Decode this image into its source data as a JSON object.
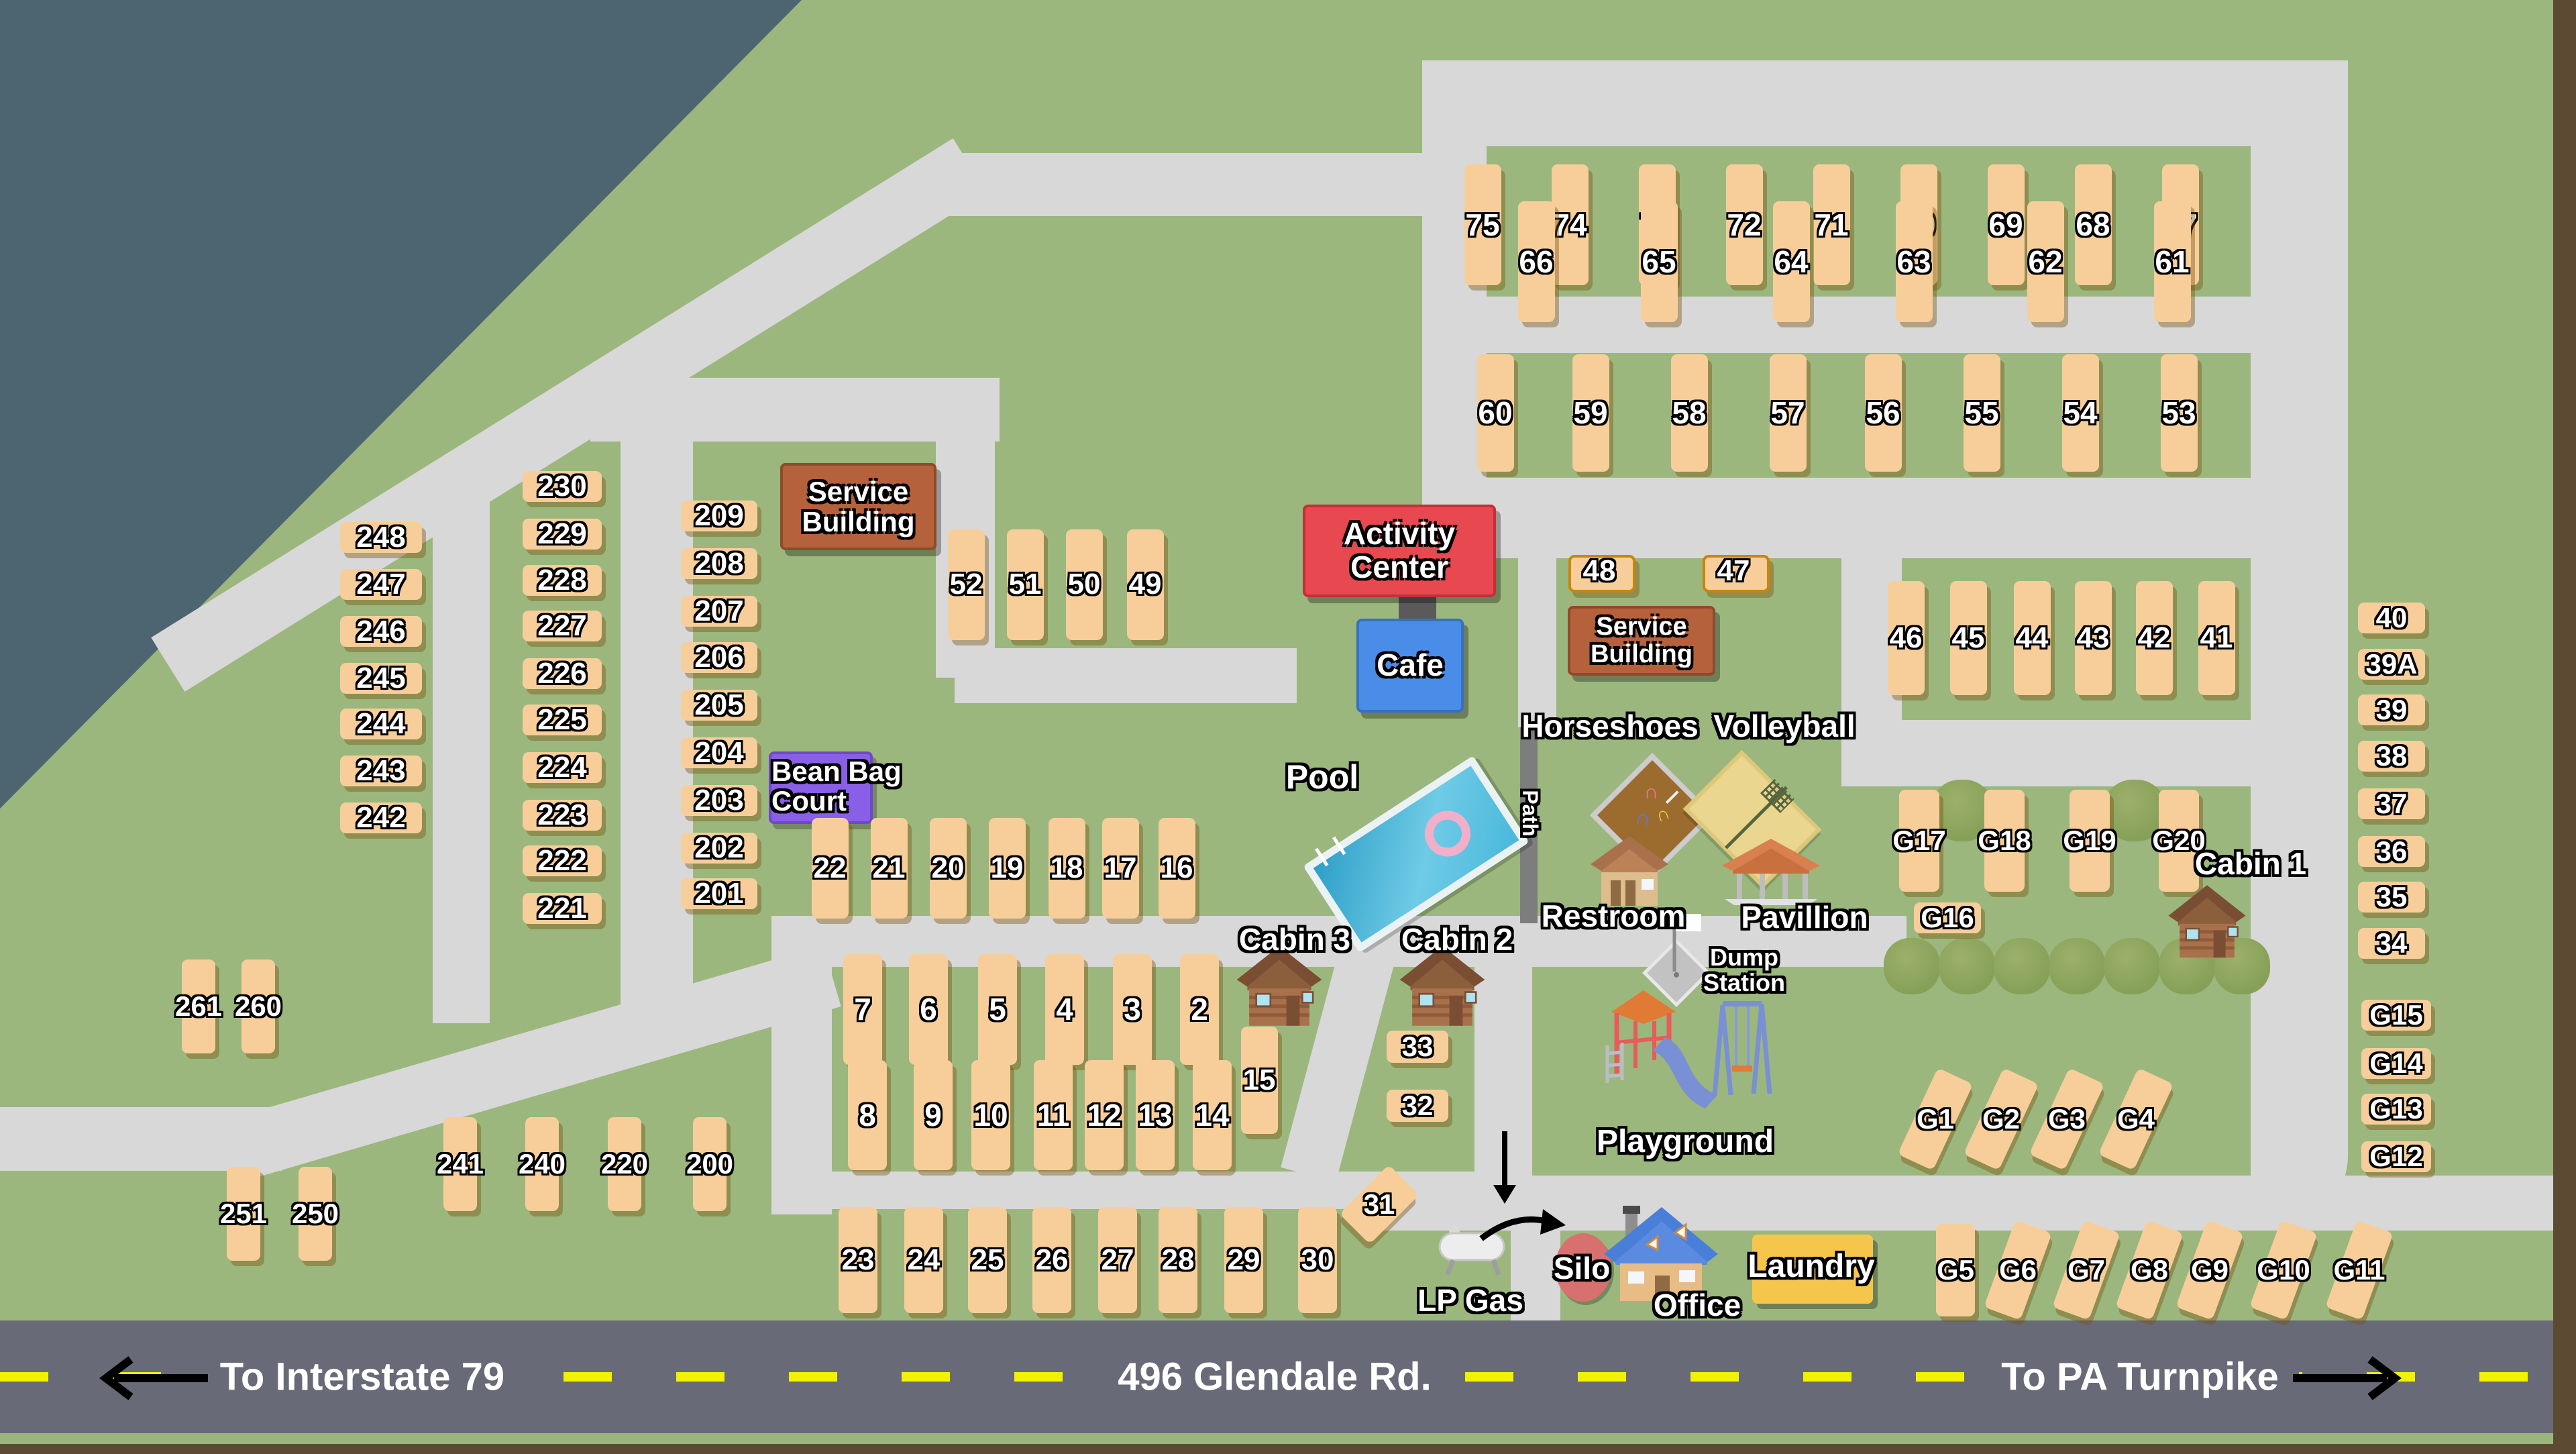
{
  "sites": {
    "row_75_67": [
      "75",
      "74",
      "73",
      "72",
      "71",
      "70",
      "69",
      "68",
      "67"
    ],
    "row_66_61": [
      "66",
      "65",
      "64",
      "63",
      "62",
      "61"
    ],
    "row_60_53": [
      "60",
      "59",
      "58",
      "57",
      "56",
      "55",
      "54",
      "53"
    ],
    "col_248_242": [
      "248",
      "247",
      "246",
      "245",
      "244",
      "243",
      "242"
    ],
    "col_230_221": [
      "230",
      "229",
      "228",
      "227",
      "226",
      "225",
      "224",
      "223",
      "222",
      "221"
    ],
    "col_209_201": [
      "209",
      "208",
      "207",
      "206",
      "205",
      "204",
      "203",
      "202",
      "201"
    ],
    "row_52_49": [
      "52",
      "51",
      "50",
      "49"
    ],
    "pair_48_47": [
      "48",
      "47"
    ],
    "row_46_41": [
      "46",
      "45",
      "44",
      "43",
      "42",
      "41"
    ],
    "col_40_34": [
      "40",
      "39A",
      "39",
      "38",
      "37",
      "36",
      "35",
      "34"
    ],
    "col_g15_g12": [
      "G15",
      "G14",
      "G13",
      "G12"
    ],
    "row_22_16": [
      "22",
      "21",
      "20",
      "19",
      "18",
      "17",
      "16"
    ],
    "row_7_2": [
      "7",
      "6",
      "5",
      "4",
      "3",
      "2"
    ],
    "site_15": [
      "15"
    ],
    "row_8_14": [
      "8",
      "9",
      "10",
      "11",
      "12",
      "13",
      "14"
    ],
    "row_23_30": [
      "23",
      "24",
      "25",
      "26",
      "27",
      "28",
      "29",
      "30"
    ],
    "pair_261_260": [
      "261",
      "260"
    ],
    "row_241_200": [
      "241",
      "240",
      "220",
      "200"
    ],
    "pair_251_250": [
      "251",
      "250"
    ],
    "col_33_32": [
      "33",
      "32"
    ],
    "site_31": [
      "31"
    ],
    "row_g17_g20": [
      "G17",
      "G18",
      "G19",
      "G20"
    ],
    "site_g16": [
      "G16"
    ],
    "row_g1_g4": [
      "G1",
      "G2",
      "G3",
      "G4"
    ],
    "row_g5_g11": [
      "G5",
      "G6",
      "G7",
      "G8",
      "G9",
      "G10",
      "G11"
    ]
  },
  "buildings": {
    "service_building_1": "Service Building",
    "service_building_2": "Service Building",
    "activity_center": "Activity Center",
    "cafe": "Cafe",
    "bean_bag_court": "Bean Bag Court",
    "laundry": "Laundry",
    "office": "Office",
    "silo": "Silo",
    "lp_gas": "LP Gas"
  },
  "amenities": {
    "pool": "Pool",
    "path": "Path",
    "horseshoes": "Horseshoes",
    "volleyball": "Volleyball",
    "restroom": "Restroom",
    "pavillion": "Pavillion",
    "playground": "Playground",
    "dump_station": "Dump Station",
    "cabin_1": "Cabin 1",
    "cabin_2": "Cabin 2",
    "cabin_3": "Cabin 3"
  },
  "road": {
    "left_label": "To Interstate 79",
    "center_label": "496 Glendale Rd.",
    "right_label": "To PA Turnpike"
  },
  "colors": {
    "grass_green": "#9BB77D",
    "road_gray": "#D8D8D8",
    "highway_gray": "#696A78",
    "dash_yellow": "#F2F200",
    "slate_outside": "#4D6471",
    "site_tan": "#F7CE9A",
    "activity_center_red": "#E8484F",
    "cafe_blue": "#4A8DE8",
    "service_brown": "#B5613C",
    "bean_bag_purple": "#8A5FE8",
    "laundry_yellow": "#F6C64C",
    "silo_red": "#D97070",
    "frame_brown": "#5C4A33"
  }
}
